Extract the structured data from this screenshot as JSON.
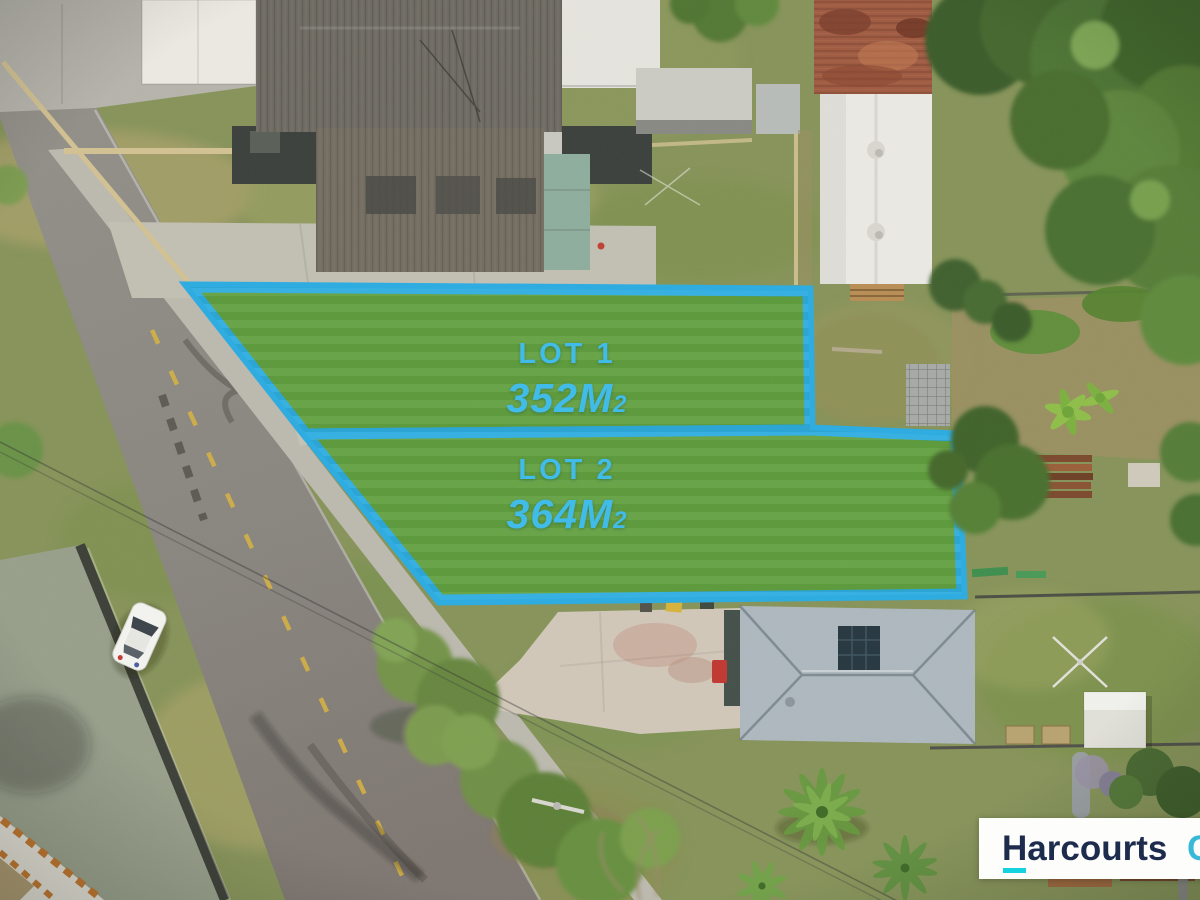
{
  "brand": {
    "name": "Harcourts",
    "partial_suffix": "C",
    "navy": "#1d2b4d",
    "underline_cyan": "#14d2e0",
    "suffix_cyan": "#38b9d8"
  },
  "lots": [
    {
      "label": "LOT 1",
      "area": "352M",
      "area_sub": "2"
    },
    {
      "label": "LOT 2",
      "area": "364M",
      "area_sub": "2"
    }
  ],
  "overlay": {
    "boundary_color": "#2bace2",
    "label_color": "#41bce8",
    "lot_fill": "#61a03f"
  }
}
